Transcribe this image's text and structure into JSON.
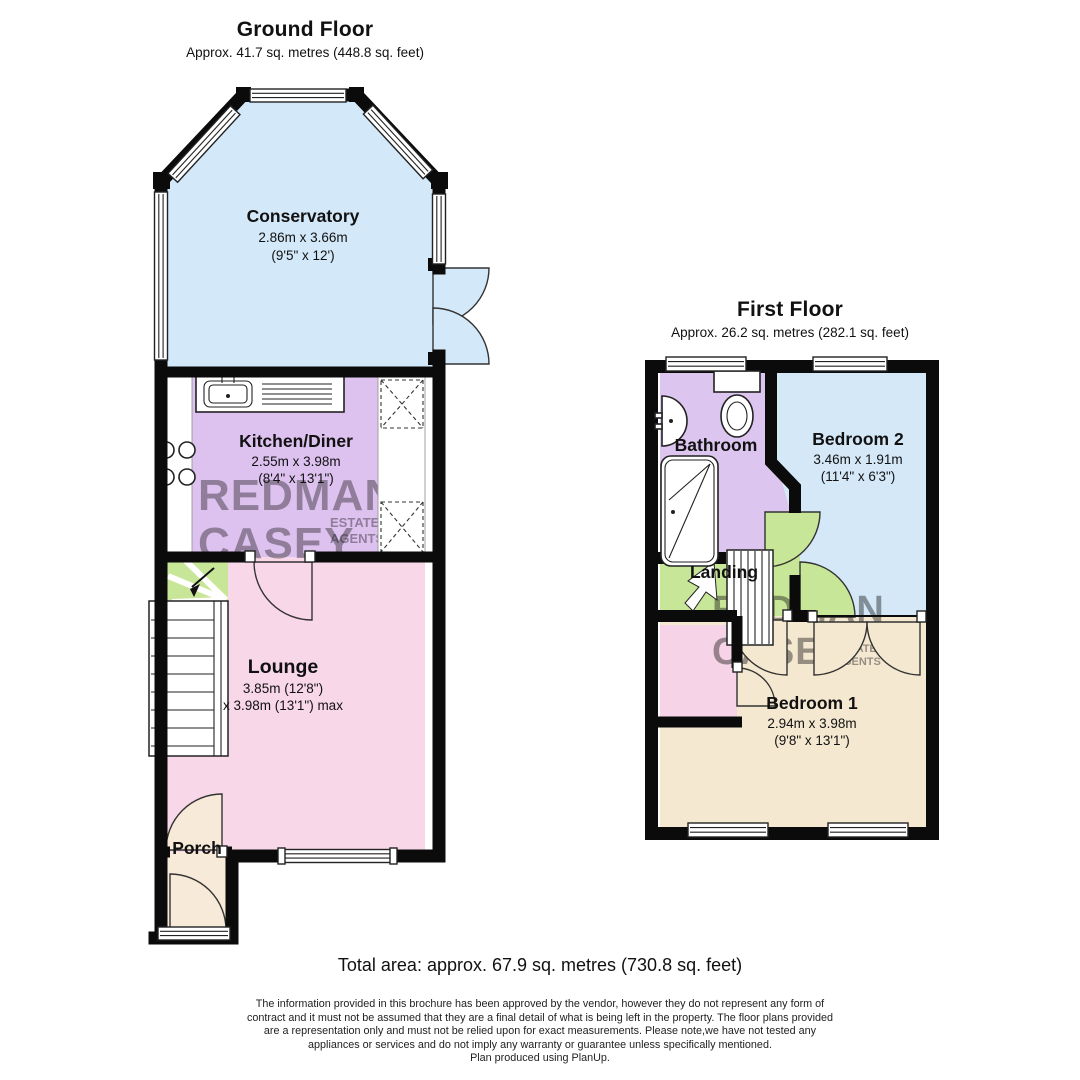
{
  "ground_floor": {
    "title": "Ground Floor",
    "area": "Approx. 41.7 sq. metres (448.8 sq. feet)",
    "rooms": {
      "conservatory": {
        "name": "Conservatory",
        "dims_m": "2.86m x 3.66m",
        "dims_ft": "(9'5\" x 12')"
      },
      "kitchen": {
        "name": "Kitchen/Diner",
        "dims_m": "2.55m x 3.98m",
        "dims_ft": "(8'4\" x 13'1\")"
      },
      "lounge": {
        "name": "Lounge",
        "dims_m": "3.85m (12'8\")",
        "dims_ft": "x 3.98m (13'1\") max"
      },
      "porch": {
        "name": "Porch"
      }
    }
  },
  "first_floor": {
    "title": "First Floor",
    "area": "Approx. 26.2 sq. metres (282.1 sq. feet)",
    "rooms": {
      "bathroom": {
        "name": "Bathroom"
      },
      "bedroom2": {
        "name": "Bedroom 2",
        "dims_m": "3.46m x 1.91m",
        "dims_ft": "(11'4\" x 6'3\")"
      },
      "landing": {
        "name": "Landing"
      },
      "bedroom1": {
        "name": "Bedroom 1",
        "dims_m": "2.94m x 3.98m",
        "dims_ft": "(9'8\" x 13'1\")"
      }
    }
  },
  "watermark": {
    "line1": "REDMAN",
    "line2": "CASEY",
    "sub1": "ESTATE",
    "sub2": "AGENTS"
  },
  "footer": {
    "total_area": "Total area: approx. 67.9 sq. metres (730.8 sq. feet)",
    "disclaimer_lines": [
      "The information provided in this brochure has been approved by the vendor, however they do not represent any form of",
      "contract and it must not be assumed that they are a final detail of what is being left in the property. The floor plans provided",
      "are a representation only and must not be relied upon for exact measurements. Please note,we have not tested any",
      "appliances or services and do not imply any warranty or guarantee unless specifically mentioned.",
      "Plan produced using PlanUp."
    ]
  },
  "colors": {
    "conservatory_blue": "#d3e8f9",
    "kitchen_purple": "#ddc1ef",
    "lounge_pink": "#f8d7e8",
    "porch_cream": "#f7ead8",
    "bathroom_purple": "#dcc5ee",
    "bedroom2_blue": "#d5e8f8",
    "bedroom1_cream": "#f5e8d0",
    "landing_green": "#c8e698",
    "closet_pink": "#f6d3e6",
    "wall_black": "#0b0b0b",
    "watermark_pink": "#d173a0",
    "watermark_red": "#c25a6e"
  }
}
